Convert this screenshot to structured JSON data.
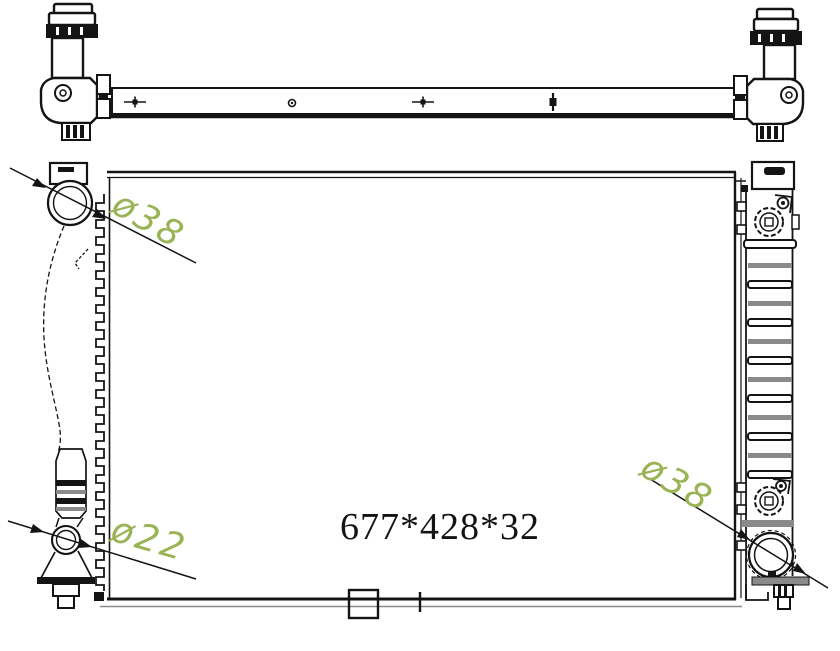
{
  "drawing": {
    "type": "technical-line-drawing",
    "subject": "automotive radiator - top view and front view",
    "annotations": {
      "port_top_left_diameter": "ø38",
      "port_bottom_left_diameter": "ø22",
      "port_bottom_right_diameter": "ø38",
      "overall_size": "677*428*32"
    },
    "colors": {
      "ink": "#141414",
      "annotation_green": "#9ab355",
      "rib_gray": "#8a8a8a",
      "background": "#ffffff"
    }
  }
}
